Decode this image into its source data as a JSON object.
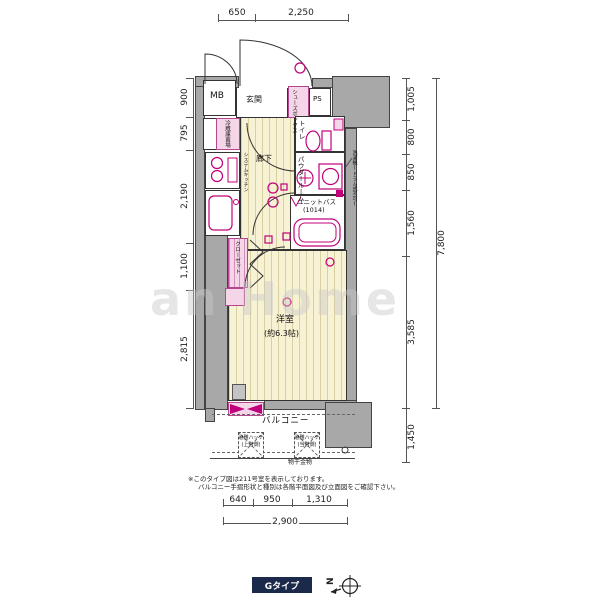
{
  "labels": {
    "mb": "MB",
    "genkan": "玄関",
    "shoes_box": "シューズボックス",
    "ps": "PS",
    "fridge": "冷蔵庫置場",
    "system_kitchen": "システムキッチン",
    "hallway": "廊下",
    "toilet": "トイレ",
    "powder_room": "パウダールーム",
    "unit_bath": "ユニットバス",
    "unit_bath_size": "(1014)",
    "washer_note": "洗濯機(ドラム式不可)",
    "closet": "クローゼット",
    "western_room": "洋室",
    "western_room_size": "(約6.3帖)",
    "balcony": "バルコニー",
    "hatch1_line1": "避難ハッチ",
    "hatch1_line2": "(上階側)",
    "hatch2_line1": "避難ハッチ",
    "hatch2_line2": "(当階側)",
    "drying_hardware": "物干金物"
  },
  "dims": {
    "top": [
      "650",
      "2,250"
    ],
    "left": [
      "900",
      "795",
      "2,190",
      "1,100",
      "2,815"
    ],
    "right": [
      "1,005",
      "800",
      "850",
      "1,560",
      "3,585"
    ],
    "right_total": "7,800",
    "right_bottom": "1,450",
    "bottom": [
      "640",
      "950",
      "1,310"
    ],
    "bottom_total": "2,900"
  },
  "notes": {
    "line1": "※このタイプ図は211号室を表示しております。",
    "line2": "バルコニー手摺形状と種別は各階平面図及び立面図をご確認下さい。"
  },
  "footer": {
    "type_label": "Gタイプ",
    "north": "N"
  },
  "watermark": "an Home",
  "colors": {
    "accent_magenta": "#c0007a",
    "wall_gray": "#a8a8a8",
    "pink_fill": "#f4d6e8",
    "floor_tan": "#f8f2d4",
    "footer_navy": "#1b2a4a"
  }
}
